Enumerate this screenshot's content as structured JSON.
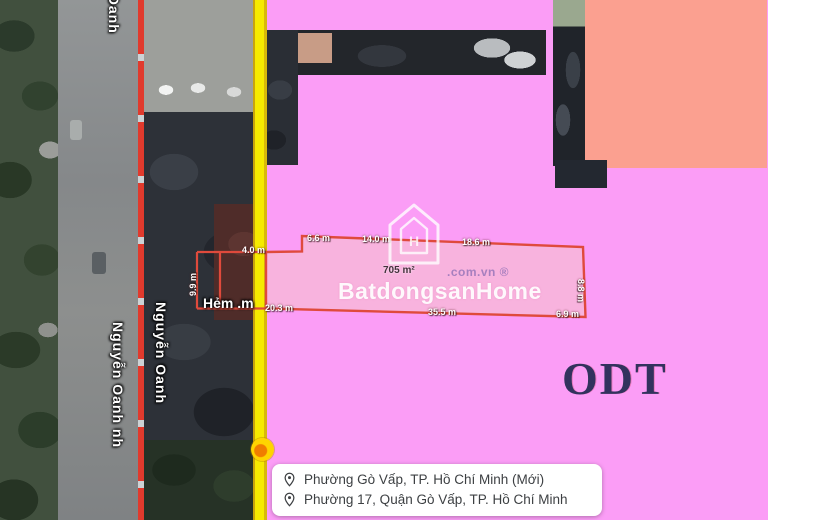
{
  "map": {
    "watermark": {
      "brand": "BatdongsanHome",
      "domain": ".com.vn ®",
      "icon": "house-logo-icon",
      "icon_letter": "H"
    },
    "zone_label": "ODT",
    "parcel": {
      "area": "705 m²",
      "measurements": {
        "top_ext": "4.0 m",
        "top1": "6.6 m",
        "top2": "14.0 m",
        "top3": "18.6 m",
        "right_side": "8.8 m",
        "left_ext_side": "9.9 m",
        "bottom1": "20.3 m",
        "bottom2": "35.5 m",
        "bottom3": "6.9 m"
      }
    },
    "streets": {
      "oanh_top": "Oanh",
      "nguyen_oanh_right": "Nguyễn Oanh",
      "nguyen_oanh_left": "Nguyễn Oanh nh",
      "hem": "Hẻm .m"
    },
    "info_box": {
      "rows": [
        {
          "icon": "location-pin-icon",
          "text": "Phường Gò Vấp, TP. Hồ Chí Minh (Mới)"
        },
        {
          "icon": "location-pin-icon",
          "text": "Phường 17, Quận Gò Vấp, TP. Hồ Chí Minh"
        }
      ]
    },
    "colors": {
      "zone_pink": "#fb9df6",
      "zone_salmon": "#fba090",
      "parcel_fill": "#f7b6db",
      "boundary_red": "#df4a3c",
      "road_edge_yellow": "#f6ea00",
      "odt_text": "#32325e"
    }
  }
}
